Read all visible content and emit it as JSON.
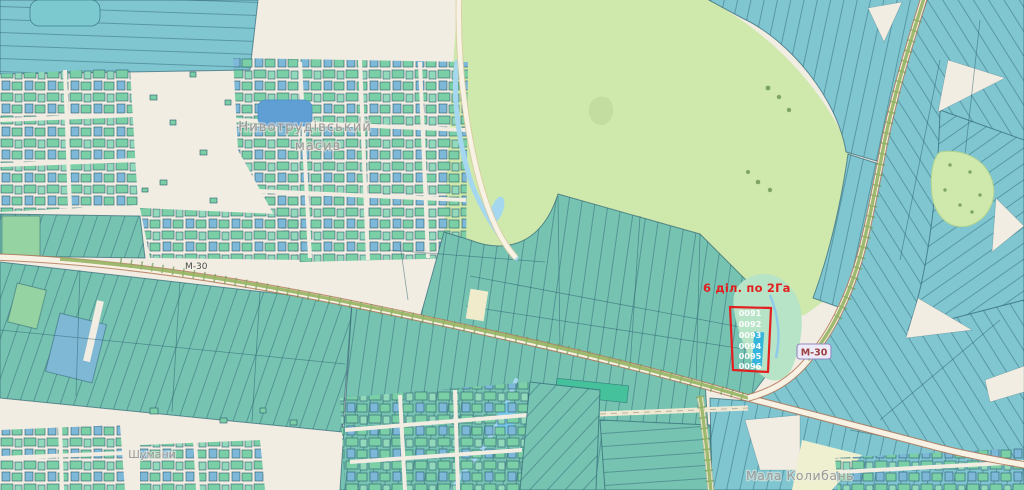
{
  "map": {
    "annotation": {
      "text": "6 діл. по 2Га"
    },
    "highlight": {
      "parcels": [
        "0091",
        "0092",
        "0093",
        "0094",
        "0095",
        "0096"
      ]
    },
    "roads": {
      "ref": "М-30"
    },
    "places": {
      "masiv_line1": "Нивотрудівський",
      "masiv_line2": "масив",
      "village_sw": "Шумани",
      "village_se": "Мала Колибань"
    },
    "colors": {
      "background": "#f1ede2",
      "field_teal": "#76c3b2",
      "field_blue": "#7fc6d1",
      "strip_line": "#2b5d6e",
      "border_dark": "#2b5d6e",
      "village_green": "#7bcfa6",
      "village_green2": "#92d8bb",
      "village_blue": "#7db8d8",
      "meadow_green": "#cfe8ac",
      "meadow_edge": "#b9d98e",
      "water_blue": "#a5d8ef",
      "pond_blue": "#5f9fd4",
      "wetland": "#b7e3c6",
      "road_fill": "#f7f2e4",
      "road_casing": "#b5795a",
      "tree_line": "#6a9a52",
      "olive": "#95b261",
      "dirt": "#efe9d3",
      "accent_red": "#e31f1f",
      "parcel_label": "#ffffff",
      "label_gray": "#9a9a9a",
      "badge_bg": "#edeaf8",
      "badge_border": "#928ac2",
      "badge_text": "#9c4040",
      "bright_green": "#45c29b",
      "pale_field": "#eef0cf"
    }
  }
}
